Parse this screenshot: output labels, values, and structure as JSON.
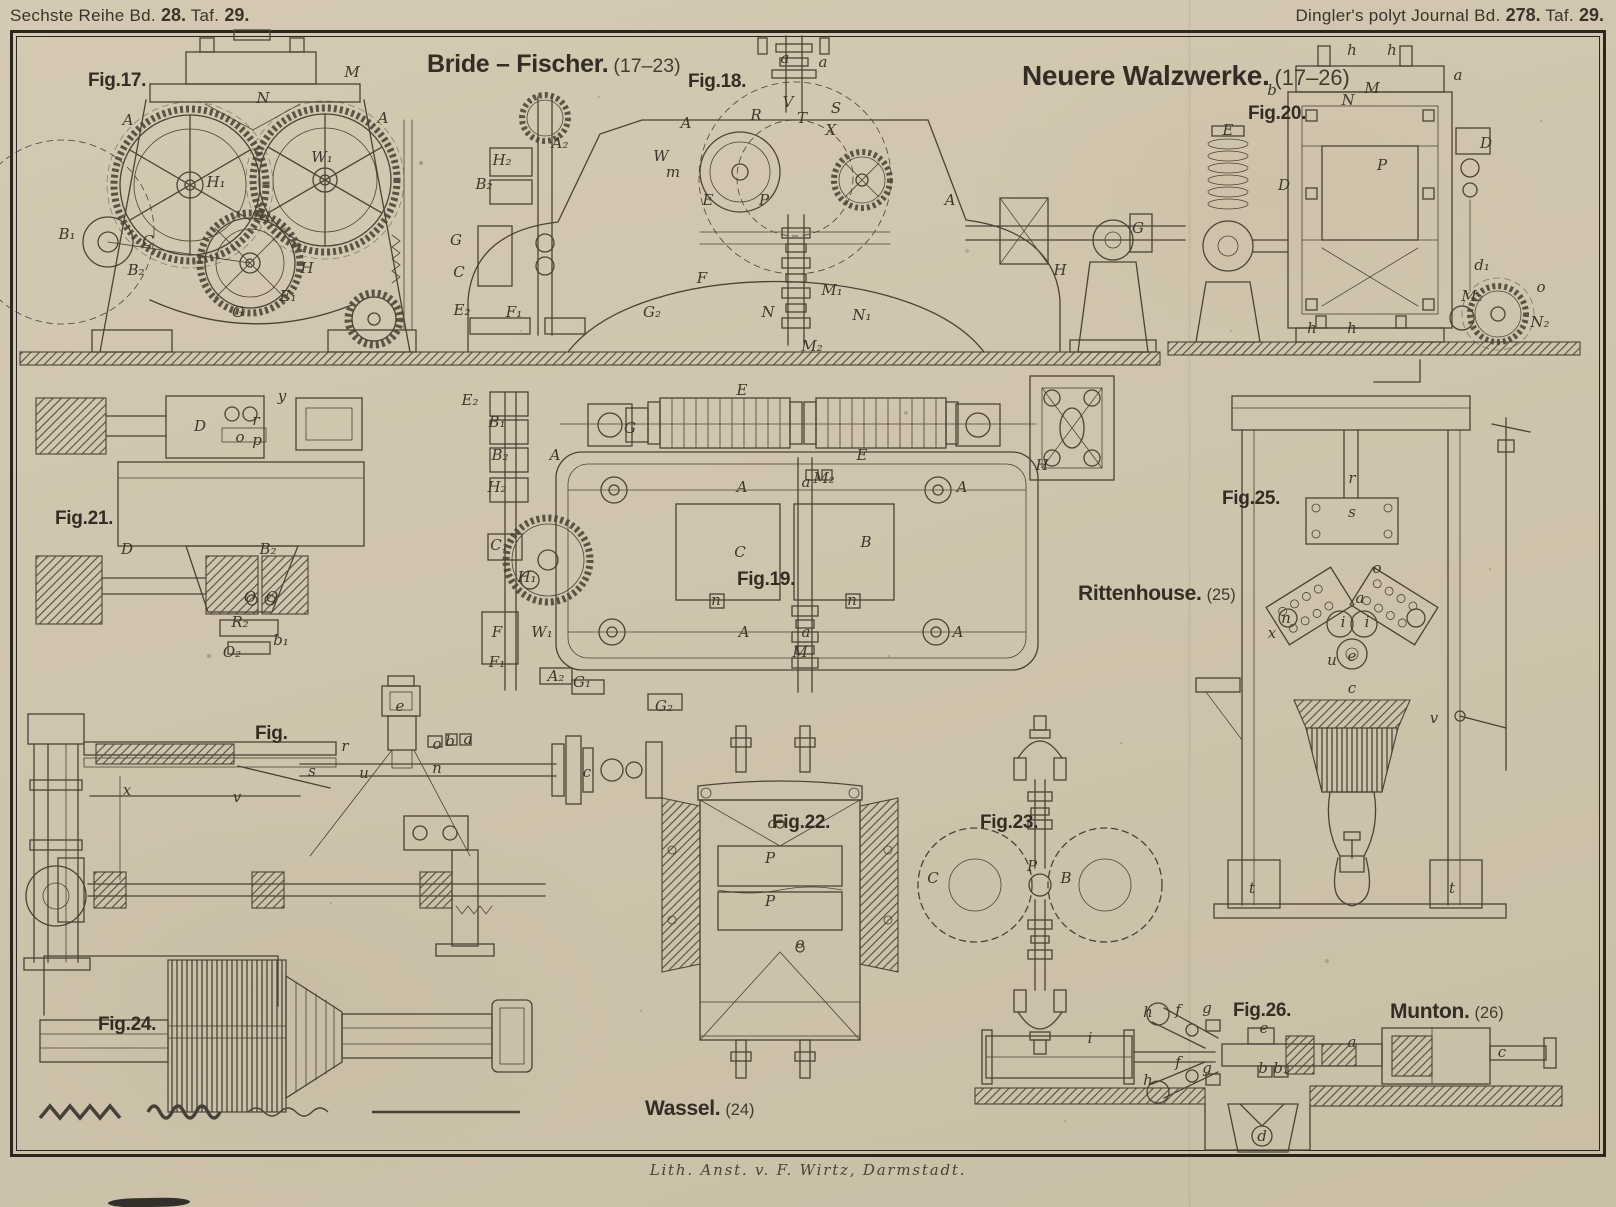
{
  "header": {
    "left_series": "Sechste Reihe Bd.",
    "left_vol": "28.",
    "left_taf": "Taf.",
    "left_plate": "29.",
    "right_journal": "Dingler's polyt Journal Bd.",
    "right_vol": "278.",
    "right_taf": "Taf.",
    "right_plate": "29."
  },
  "titles": {
    "bride_fischer": {
      "name": "Bride – Fischer.",
      "range": "(17–23)"
    },
    "neuere_walzwerke": {
      "name": "Neuere Walzwerke.",
      "range": "(17–26)"
    },
    "rittenhouse": {
      "name": "Rittenhouse.",
      "range": "(25)"
    },
    "wassel": {
      "name": "Wassel.",
      "range": "(24)"
    },
    "munton": {
      "name": "Munton.",
      "range": "(26)"
    }
  },
  "figures": {
    "fig17": "Fig.17.",
    "fig18": "Fig.18.",
    "fig19": "Fig.19.",
    "fig20": "Fig.20.",
    "fig21": "Fig.21.",
    "fig22": "Fig.22.",
    "fig23": "Fig.23.",
    "fig24": "Fig.24.",
    "fig25": "Fig.25.",
    "fig26": "Fig.26.",
    "fig_plain": "Fig."
  },
  "footer": {
    "credit": "Lith. Anst. v. F. Wirtz, Darmstadt."
  },
  "colors": {
    "paper": "#cfc4ad",
    "ink": "#4a4336",
    "frame": "#2b261f",
    "text": "#39332a"
  },
  "part_labels": [
    {
      "t": "N",
      "x": 263,
      "y": 98
    },
    {
      "t": "A",
      "x": 128,
      "y": 120
    },
    {
      "t": "A",
      "x": 383,
      "y": 118
    },
    {
      "t": "M",
      "x": 352,
      "y": 72
    },
    {
      "t": "W₁",
      "x": 322,
      "y": 157
    },
    {
      "t": "H₁",
      "x": 216,
      "y": 182
    },
    {
      "t": "B₁",
      "x": 67,
      "y": 234
    },
    {
      "t": "B₂",
      "x": 136,
      "y": 270
    },
    {
      "t": "C",
      "x": 148,
      "y": 241
    },
    {
      "t": "H",
      "x": 307,
      "y": 268
    },
    {
      "t": "G",
      "x": 238,
      "y": 312
    },
    {
      "t": "E₁",
      "x": 288,
      "y": 296
    },
    {
      "t": "a",
      "x": 785,
      "y": 58
    },
    {
      "t": "a",
      "x": 823,
      "y": 62
    },
    {
      "t": "V",
      "x": 788,
      "y": 102
    },
    {
      "t": "T",
      "x": 802,
      "y": 118
    },
    {
      "t": "S",
      "x": 836,
      "y": 108
    },
    {
      "t": "R",
      "x": 756,
      "y": 115
    },
    {
      "t": "X",
      "x": 831,
      "y": 130
    },
    {
      "t": "A",
      "x": 686,
      "y": 123
    },
    {
      "t": "W",
      "x": 661,
      "y": 156
    },
    {
      "t": "H₂",
      "x": 502,
      "y": 160
    },
    {
      "t": "B₂",
      "x": 484,
      "y": 184
    },
    {
      "t": "A₂",
      "x": 560,
      "y": 143
    },
    {
      "t": "m",
      "x": 673,
      "y": 172
    },
    {
      "t": "E",
      "x": 708,
      "y": 200
    },
    {
      "t": "P",
      "x": 764,
      "y": 200
    },
    {
      "t": "G",
      "x": 456,
      "y": 240
    },
    {
      "t": "C",
      "x": 459,
      "y": 272
    },
    {
      "t": "E₂",
      "x": 462,
      "y": 310
    },
    {
      "t": "F₁",
      "x": 514,
      "y": 312
    },
    {
      "t": "G₂",
      "x": 652,
      "y": 312
    },
    {
      "t": "F",
      "x": 702,
      "y": 278
    },
    {
      "t": "M₁",
      "x": 832,
      "y": 290
    },
    {
      "t": "N",
      "x": 768,
      "y": 312
    },
    {
      "t": "N₁",
      "x": 862,
      "y": 315
    },
    {
      "t": "M₂",
      "x": 812,
      "y": 346
    },
    {
      "t": "A",
      "x": 950,
      "y": 200
    },
    {
      "t": "H",
      "x": 1060,
      "y": 270
    },
    {
      "t": "G",
      "x": 1138,
      "y": 228
    },
    {
      "t": "h",
      "x": 1352,
      "y": 50
    },
    {
      "t": "h",
      "x": 1392,
      "y": 50
    },
    {
      "t": "N",
      "x": 1348,
      "y": 100
    },
    {
      "t": "M",
      "x": 1372,
      "y": 88
    },
    {
      "t": "b",
      "x": 1272,
      "y": 90
    },
    {
      "t": "a",
      "x": 1458,
      "y": 75
    },
    {
      "t": "E",
      "x": 1228,
      "y": 130
    },
    {
      "t": "D",
      "x": 1284,
      "y": 185
    },
    {
      "t": "P",
      "x": 1382,
      "y": 165
    },
    {
      "t": "D",
      "x": 1486,
      "y": 143
    },
    {
      "t": "M₂",
      "x": 1472,
      "y": 296
    },
    {
      "t": "N₂",
      "x": 1540,
      "y": 322
    },
    {
      "t": "o",
      "x": 1541,
      "y": 287
    },
    {
      "t": "d₁",
      "x": 1482,
      "y": 265
    },
    {
      "t": "h",
      "x": 1312,
      "y": 328
    },
    {
      "t": "h",
      "x": 1352,
      "y": 328
    },
    {
      "t": "y",
      "x": 282,
      "y": 396
    },
    {
      "t": "D",
      "x": 200,
      "y": 426
    },
    {
      "t": "r",
      "x": 256,
      "y": 420
    },
    {
      "t": "o",
      "x": 240,
      "y": 437
    },
    {
      "t": "p",
      "x": 257,
      "y": 440
    },
    {
      "t": "D",
      "x": 127,
      "y": 549
    },
    {
      "t": "B₂",
      "x": 268,
      "y": 549
    },
    {
      "t": "O",
      "x": 250,
      "y": 597
    },
    {
      "t": "O",
      "x": 272,
      "y": 597
    },
    {
      "t": "R₂",
      "x": 240,
      "y": 622
    },
    {
      "t": "b₁",
      "x": 281,
      "y": 640
    },
    {
      "t": "O₂",
      "x": 232,
      "y": 652
    },
    {
      "t": "E₂",
      "x": 470,
      "y": 400
    },
    {
      "t": "B₁",
      "x": 497,
      "y": 422
    },
    {
      "t": "G",
      "x": 630,
      "y": 428
    },
    {
      "t": "E",
      "x": 742,
      "y": 390
    },
    {
      "t": "E",
      "x": 862,
      "y": 455
    },
    {
      "t": "B₂",
      "x": 500,
      "y": 455
    },
    {
      "t": "A",
      "x": 555,
      "y": 455
    },
    {
      "t": "H₂",
      "x": 497,
      "y": 487
    },
    {
      "t": "A",
      "x": 742,
      "y": 487
    },
    {
      "t": "a",
      "x": 806,
      "y": 482
    },
    {
      "t": "M₂",
      "x": 824,
      "y": 478
    },
    {
      "t": "A",
      "x": 962,
      "y": 487
    },
    {
      "t": "C",
      "x": 740,
      "y": 552
    },
    {
      "t": "B",
      "x": 866,
      "y": 542
    },
    {
      "t": "C₁",
      "x": 499,
      "y": 545
    },
    {
      "t": "H₁",
      "x": 527,
      "y": 577
    },
    {
      "t": "n",
      "x": 716,
      "y": 600
    },
    {
      "t": "n",
      "x": 852,
      "y": 600
    },
    {
      "t": "W₁",
      "x": 542,
      "y": 632
    },
    {
      "t": "A",
      "x": 744,
      "y": 632
    },
    {
      "t": "a",
      "x": 806,
      "y": 632
    },
    {
      "t": "A",
      "x": 958,
      "y": 632
    },
    {
      "t": "F",
      "x": 497,
      "y": 632
    },
    {
      "t": "F₁",
      "x": 497,
      "y": 662
    },
    {
      "t": "A₂",
      "x": 556,
      "y": 676
    },
    {
      "t": "G₁",
      "x": 582,
      "y": 682
    },
    {
      "t": "G₂",
      "x": 664,
      "y": 706
    },
    {
      "t": "M",
      "x": 800,
      "y": 652
    },
    {
      "t": "H",
      "x": 1042,
      "y": 465
    },
    {
      "t": "r",
      "x": 1352,
      "y": 478
    },
    {
      "t": "s",
      "x": 1352,
      "y": 512
    },
    {
      "t": "o",
      "x": 1377,
      "y": 568
    },
    {
      "t": "a",
      "x": 1360,
      "y": 598
    },
    {
      "t": "i",
      "x": 1343,
      "y": 622
    },
    {
      "t": "i",
      "x": 1367,
      "y": 622
    },
    {
      "t": "e",
      "x": 1352,
      "y": 656
    },
    {
      "t": "c",
      "x": 1352,
      "y": 688
    },
    {
      "t": "u",
      "x": 1332,
      "y": 660
    },
    {
      "t": "n",
      "x": 1286,
      "y": 618
    },
    {
      "t": "x",
      "x": 1272,
      "y": 633
    },
    {
      "t": "v",
      "x": 1434,
      "y": 718
    },
    {
      "t": "t",
      "x": 1252,
      "y": 888
    },
    {
      "t": "t",
      "x": 1452,
      "y": 888
    },
    {
      "t": "e",
      "x": 400,
      "y": 706
    },
    {
      "t": "r",
      "x": 345,
      "y": 746
    },
    {
      "t": "s",
      "x": 312,
      "y": 771
    },
    {
      "t": "o",
      "x": 437,
      "y": 744
    },
    {
      "t": "b",
      "x": 450,
      "y": 741
    },
    {
      "t": "a",
      "x": 468,
      "y": 739
    },
    {
      "t": "n",
      "x": 437,
      "y": 768
    },
    {
      "t": "u",
      "x": 364,
      "y": 773
    },
    {
      "t": "x",
      "x": 127,
      "y": 790
    },
    {
      "t": "v",
      "x": 237,
      "y": 797
    },
    {
      "t": "c",
      "x": 587,
      "y": 772
    },
    {
      "t": "o",
      "x": 772,
      "y": 823
    },
    {
      "t": "P",
      "x": 770,
      "y": 858
    },
    {
      "t": "P",
      "x": 770,
      "y": 901
    },
    {
      "t": "o",
      "x": 800,
      "y": 943
    },
    {
      "t": "C",
      "x": 933,
      "y": 878
    },
    {
      "t": "B",
      "x": 1066,
      "y": 878
    },
    {
      "t": "P",
      "x": 1032,
      "y": 866
    },
    {
      "t": "h",
      "x": 1148,
      "y": 1012
    },
    {
      "t": "h",
      "x": 1148,
      "y": 1080
    },
    {
      "t": "f",
      "x": 1178,
      "y": 1010
    },
    {
      "t": "f",
      "x": 1178,
      "y": 1062
    },
    {
      "t": "g",
      "x": 1207,
      "y": 1008
    },
    {
      "t": "g",
      "x": 1207,
      "y": 1068
    },
    {
      "t": "i",
      "x": 1090,
      "y": 1038
    },
    {
      "t": "e",
      "x": 1264,
      "y": 1028
    },
    {
      "t": "b",
      "x": 1263,
      "y": 1068
    },
    {
      "t": "b₁",
      "x": 1281,
      "y": 1068
    },
    {
      "t": "a",
      "x": 1352,
      "y": 1042
    },
    {
      "t": "c",
      "x": 1502,
      "y": 1052
    },
    {
      "t": "d",
      "x": 1262,
      "y": 1136
    }
  ]
}
